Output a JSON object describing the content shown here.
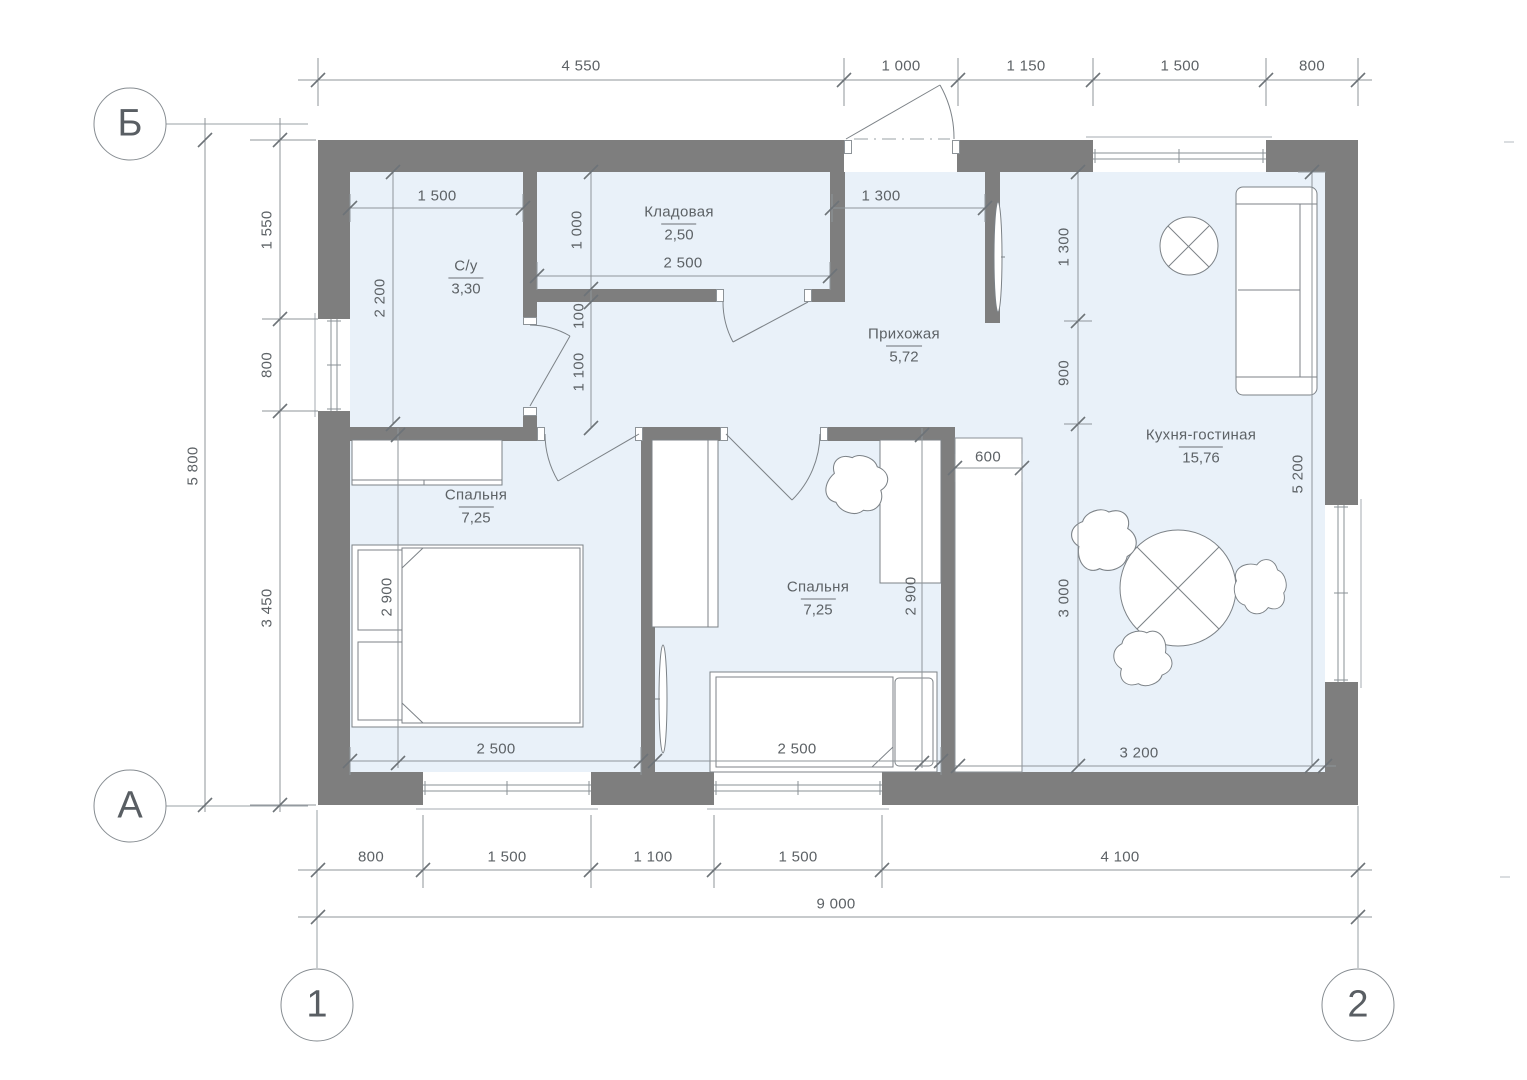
{
  "drawing": {
    "kind": "architectural floor plan"
  },
  "colors": {
    "wall": "#7e7e7e",
    "room_fill": "#e9f1f9",
    "line": "#8a9096",
    "text": "#5d6266"
  },
  "axes": {
    "row_top": "Б",
    "row_bottom": "А",
    "col_left": "1",
    "col_right": "2"
  },
  "rooms": {
    "bathroom": {
      "name": "С/у",
      "area": "3,30"
    },
    "storage": {
      "name": "Кладовая",
      "area": "2,50"
    },
    "hallway": {
      "name": "Прихожая",
      "area": "5,72"
    },
    "bedroom1": {
      "name": "Спальня",
      "area": "7,25"
    },
    "bedroom2": {
      "name": "Спальня",
      "area": "7,25"
    },
    "kitchen_living": {
      "name": "Кухня-гостиная",
      "area": "15,76"
    }
  },
  "dims": {
    "top": {
      "d1": "4 550",
      "d2": "1 000",
      "d3": "1 150",
      "d4": "1 500",
      "d5": "800"
    },
    "bottom": {
      "d1": "800",
      "d2": "1 500",
      "d3": "1 100",
      "d4": "1 500",
      "d5": "4 100",
      "total": "9 000"
    },
    "left": {
      "d1": "1 550",
      "d2": "800",
      "d3": "3 450",
      "total": "5 800"
    },
    "interior": {
      "bath_width": "1 500",
      "bath_depth": "2 200",
      "storage_depth": "1 000",
      "storage_width": "2 500",
      "wall_gap": "100",
      "hall_depth": "1 100",
      "hall_width": "1 300",
      "kitchen_seg1": "1 300",
      "kitchen_seg2": "900",
      "kitchen_seg3": "3 000",
      "kitchen_height": "5 200",
      "closet_width": "600",
      "kitchen_width": "3 200",
      "bedroom1_width": "2 500",
      "bedroom1_depth": "2 900",
      "bedroom2_width": "2 500",
      "bedroom2_depth": "2 900"
    }
  }
}
